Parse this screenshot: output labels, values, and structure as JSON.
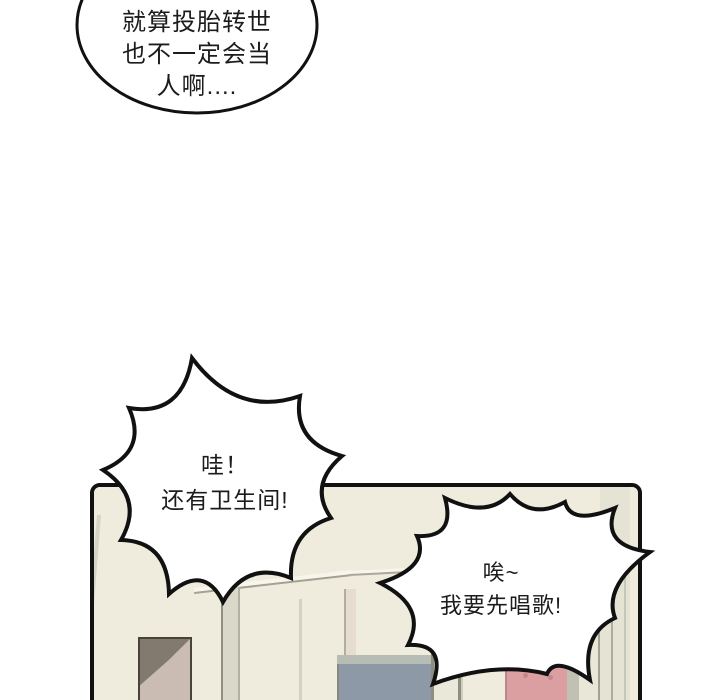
{
  "comic": {
    "thought_bubble": {
      "line1": "就算投胎转世",
      "line2": "也不一定会当",
      "line3": "人啊...."
    },
    "burst_bubble_bathroom": {
      "line1": "哇！",
      "line2": "还有卫生间!"
    },
    "burst_bubble_sing": {
      "line1": "唉~",
      "line2": "我要先唱歌!"
    }
  },
  "colors": {
    "ink": "#111111",
    "page_background": "#ffffff",
    "bubble_fill": "#ffffff",
    "wall": "#efecdd",
    "wall_highlight": "#f8f6ec",
    "sage_strip": "#d9d8c9",
    "right_wall": "#e5e3d4",
    "door_frame": "#eae8d9",
    "left_door": "#cabbb3",
    "doorway_shadow": "#837a6f",
    "blue_gray_wall": "#8e99a7",
    "blue_top_trim": "#b7bcb4",
    "pink_door": "#dc9fa1",
    "pink_door_knob": "#bf888a"
  }
}
